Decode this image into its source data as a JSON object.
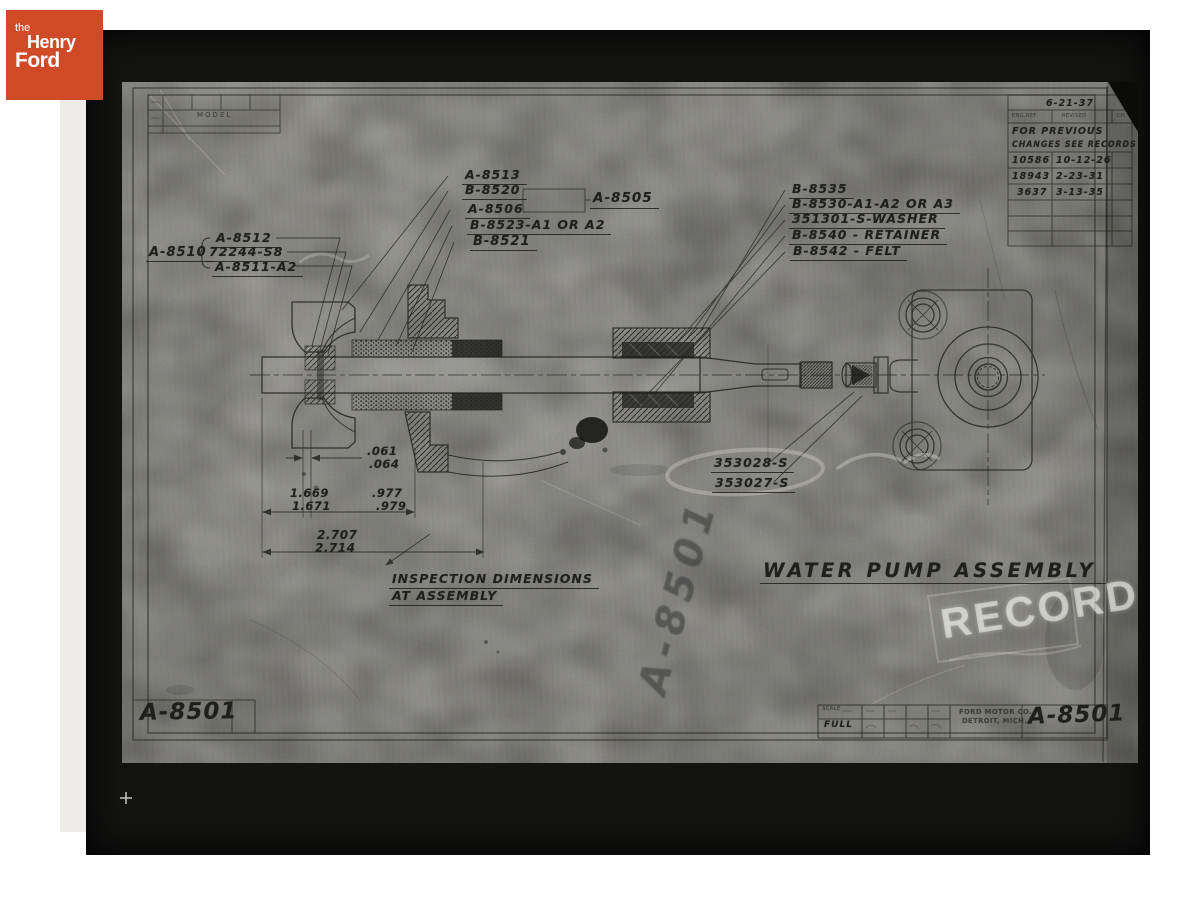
{
  "logo": {
    "the": "the",
    "henry": "Henry",
    "ford": "Ford",
    "bg_color": "#d14a28"
  },
  "drawing": {
    "title": "WATER PUMP ASSEMBLY",
    "number": "A-8501",
    "stamp_text": "RECORD",
    "watermark_text": "A-8501",
    "model_label": "MODEL",
    "inspection_note": {
      "line1": "INSPECTION DIMENSIONS",
      "line2": "AT ASSEMBLY"
    },
    "revision_table": {
      "date": "6-21-37",
      "col_headers": [
        "ENG.REF",
        "REVISED",
        "CH."
      ],
      "note_line1": "FOR PREVIOUS",
      "note_line2": "CHANGES SEE RECORDS",
      "rows": [
        {
          "ref": "10586",
          "date": "10-12-26"
        },
        {
          "ref": "18943",
          "date": "2-23-31"
        },
        {
          "ref": "3637",
          "date": "3-13-35"
        }
      ]
    },
    "callouts": {
      "left_group": {
        "label": "A-8510",
        "items": [
          "A-8512",
          "72244-S8",
          "A-8511-A2"
        ]
      },
      "center_group": {
        "items": [
          "A-8513",
          "B-8520",
          "A-8506",
          "B-8523-A1 OR A2",
          "B-8521"
        ],
        "boxed": "A-8505"
      },
      "right_group": {
        "items": [
          "B-8535",
          "B-8530-A1-A2 OR A3",
          "351301-S-WASHER",
          "B-8540 - RETAINER",
          "B-8542 - FELT"
        ]
      },
      "coupling_group": {
        "items": [
          "353028-S",
          "353027-S"
        ]
      }
    },
    "dimensions": [
      {
        "top": ".061",
        "bottom": ".064"
      },
      {
        "top": "1.669",
        "bottom": "1.671"
      },
      {
        "top": ".977",
        "bottom": ".979"
      },
      {
        "top": "2.707",
        "bottom": "2.714"
      }
    ],
    "title_block": {
      "scale_label": "SCALE",
      "scale_value": "FULL",
      "company_line1": "FORD MOTOR CO.",
      "company_line2": "DETROIT, MICH.",
      "number": "A-8501"
    },
    "corner_number": "A-8501"
  }
}
